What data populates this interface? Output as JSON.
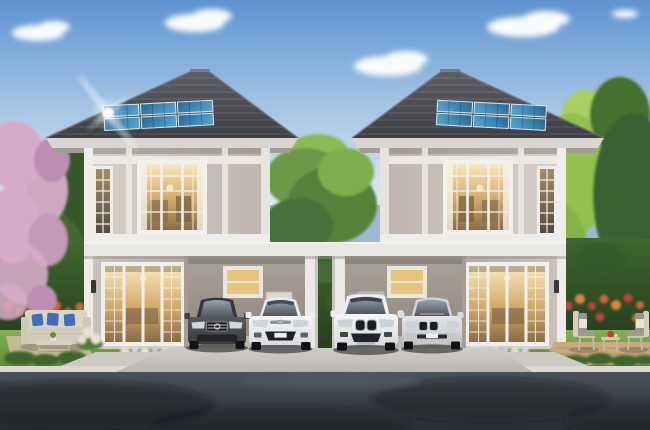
{
  "scene": {
    "description": "Architectural rendering of twin two-storey houses with rooftop solar panels, carports with parked cars, landscaped gardens and an asphalt road in the foreground",
    "time_of_day": "day, clear blue sky with soft clouds",
    "houses": [
      {
        "id": "left-house",
        "storeys": 2,
        "solar_panels": 6,
        "carport_cars": [
          "dark-gray sedan",
          "white sedan"
        ],
        "garden": "outdoor sofa with blue pillows and coffee table"
      },
      {
        "id": "right-house",
        "storeys": 2,
        "solar_panels": 6,
        "carport_cars": [
          "white SUV",
          "silver sedan"
        ],
        "garden": "two armchairs with small table and red teapot on timber deck"
      }
    ],
    "vegetation": [
      "pink blossom tree at left",
      "green trees",
      "clipped hedges",
      "orange and red flower borders",
      "lawns",
      "low shrub rows",
      "white flower beds"
    ],
    "hardscape": [
      "shared white carport beam and posts",
      "concrete driveway apron",
      "white curb",
      "asphalt road with tree shadows",
      "paved walkways",
      "patio",
      "timber deck"
    ]
  },
  "palette": {
    "sky_top": "#5e93d1",
    "sky_mid": "#a9c7e5",
    "sky_horizon": "#dfeaf3",
    "cloud_white": "#f8fbfd",
    "roof_light": "#5d5d64",
    "roof_dark": "#3e3f45",
    "fascia": "#d9d6d2",
    "solar_light": "#4f9ecb",
    "solar_dark": "#2a6694",
    "wall_up_light": "#d6d0c9",
    "wall_up_dark": "#beb6ae",
    "wall_dn_light": "#ccc4bc",
    "wall_dn_dark": "#b5ada5",
    "trim_white": "#f0eeea",
    "band_white": "#eae8e4",
    "carport_light": "#aaa199",
    "carport_dark": "#8f867e",
    "warm_glass_light": "#f7e8bd",
    "warm_glass_mid": "#d2a868",
    "warm_glass_dark": "#8b6c48",
    "glass_cool_light": "#98a1ad",
    "glass_cool_dark": "#4a515d",
    "hedge_light": "#3f662e",
    "hedge_dark": "#263f1e",
    "tree_mid": "#55813a",
    "tree_bright": "#93c050",
    "tree_dark": "#35582b",
    "blossom_pink": "#d8aac9",
    "blossom_deep": "#bf8cb4",
    "grass_light": "#83b055",
    "grass_dark": "#5a8a39",
    "patio_tan": "#cbbc9b",
    "deck_tan": "#c7a97b",
    "sofa_beige": "#d3ccbd",
    "pillow_blue": "#3f6fb8",
    "flower_orange": "#d2652f",
    "flower_red": "#c04238",
    "concrete_light": "#d0cdc8",
    "concrete_dark": "#b9b6b1",
    "curb_white": "#dcd9d4",
    "road_light": "#4c525b",
    "road_dark": "#282c33",
    "car_dark_gray": "#47474c",
    "car_white": "#f2f3f5",
    "car_silver": "#d7d9dc"
  }
}
